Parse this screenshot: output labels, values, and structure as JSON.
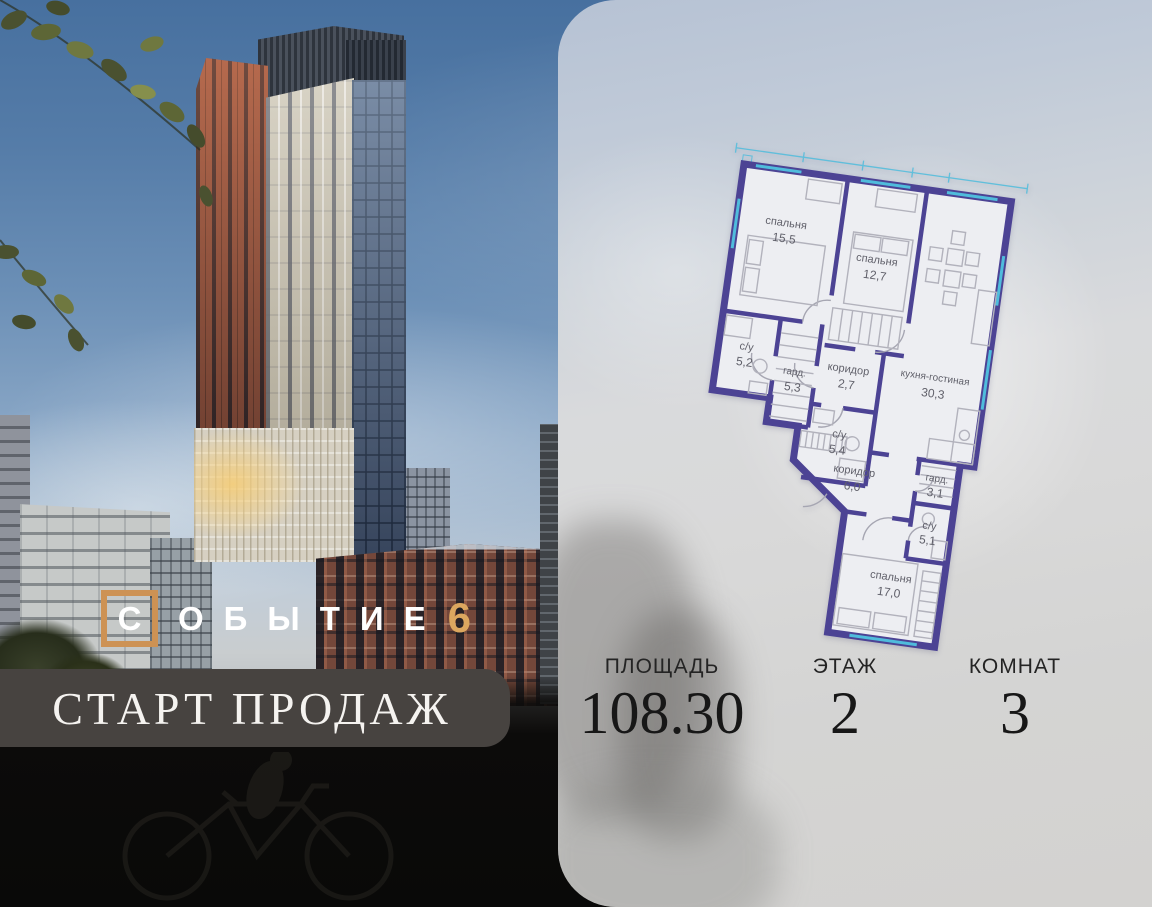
{
  "logo": {
    "first_letter": "С",
    "rest_letters": "ОБЫТИЕ",
    "number": "6"
  },
  "banner": {
    "text": "СТАРТ ПРОДАЖ"
  },
  "stats": [
    {
      "label": "ПЛОЩАДЬ",
      "value": "108.30"
    },
    {
      "label": "ЭТАЖ",
      "value": "2"
    },
    {
      "label": "КОМНАТ",
      "value": "3"
    }
  ],
  "plan": {
    "rooms": [
      {
        "name": "спальня",
        "area": "15,5"
      },
      {
        "name": "спальня",
        "area": "12,7"
      },
      {
        "name": "кухня-гостиная",
        "area": "30,3"
      },
      {
        "name": "с/у",
        "area": "5,2"
      },
      {
        "name": "гард.",
        "area": "5,3"
      },
      {
        "name": "коридор",
        "area": "2,7"
      },
      {
        "name": "с/у",
        "area": "5,4"
      },
      {
        "name": "коридор",
        "area": "6,0"
      },
      {
        "name": "гард.",
        "area": "3,1"
      },
      {
        "name": "с/у",
        "area": "5,1"
      },
      {
        "name": "спальня",
        "area": "17,0"
      }
    ],
    "total_area": "108.30"
  },
  "colors": {
    "accent_orange": "#cd9254",
    "logo_number_orange": "#dca75f",
    "banner_bg": "#474340",
    "plan_wall_purple": "#4c4394",
    "plan_window_cyan": "#4fbcdc",
    "card_gray": "#d5d6d8"
  }
}
